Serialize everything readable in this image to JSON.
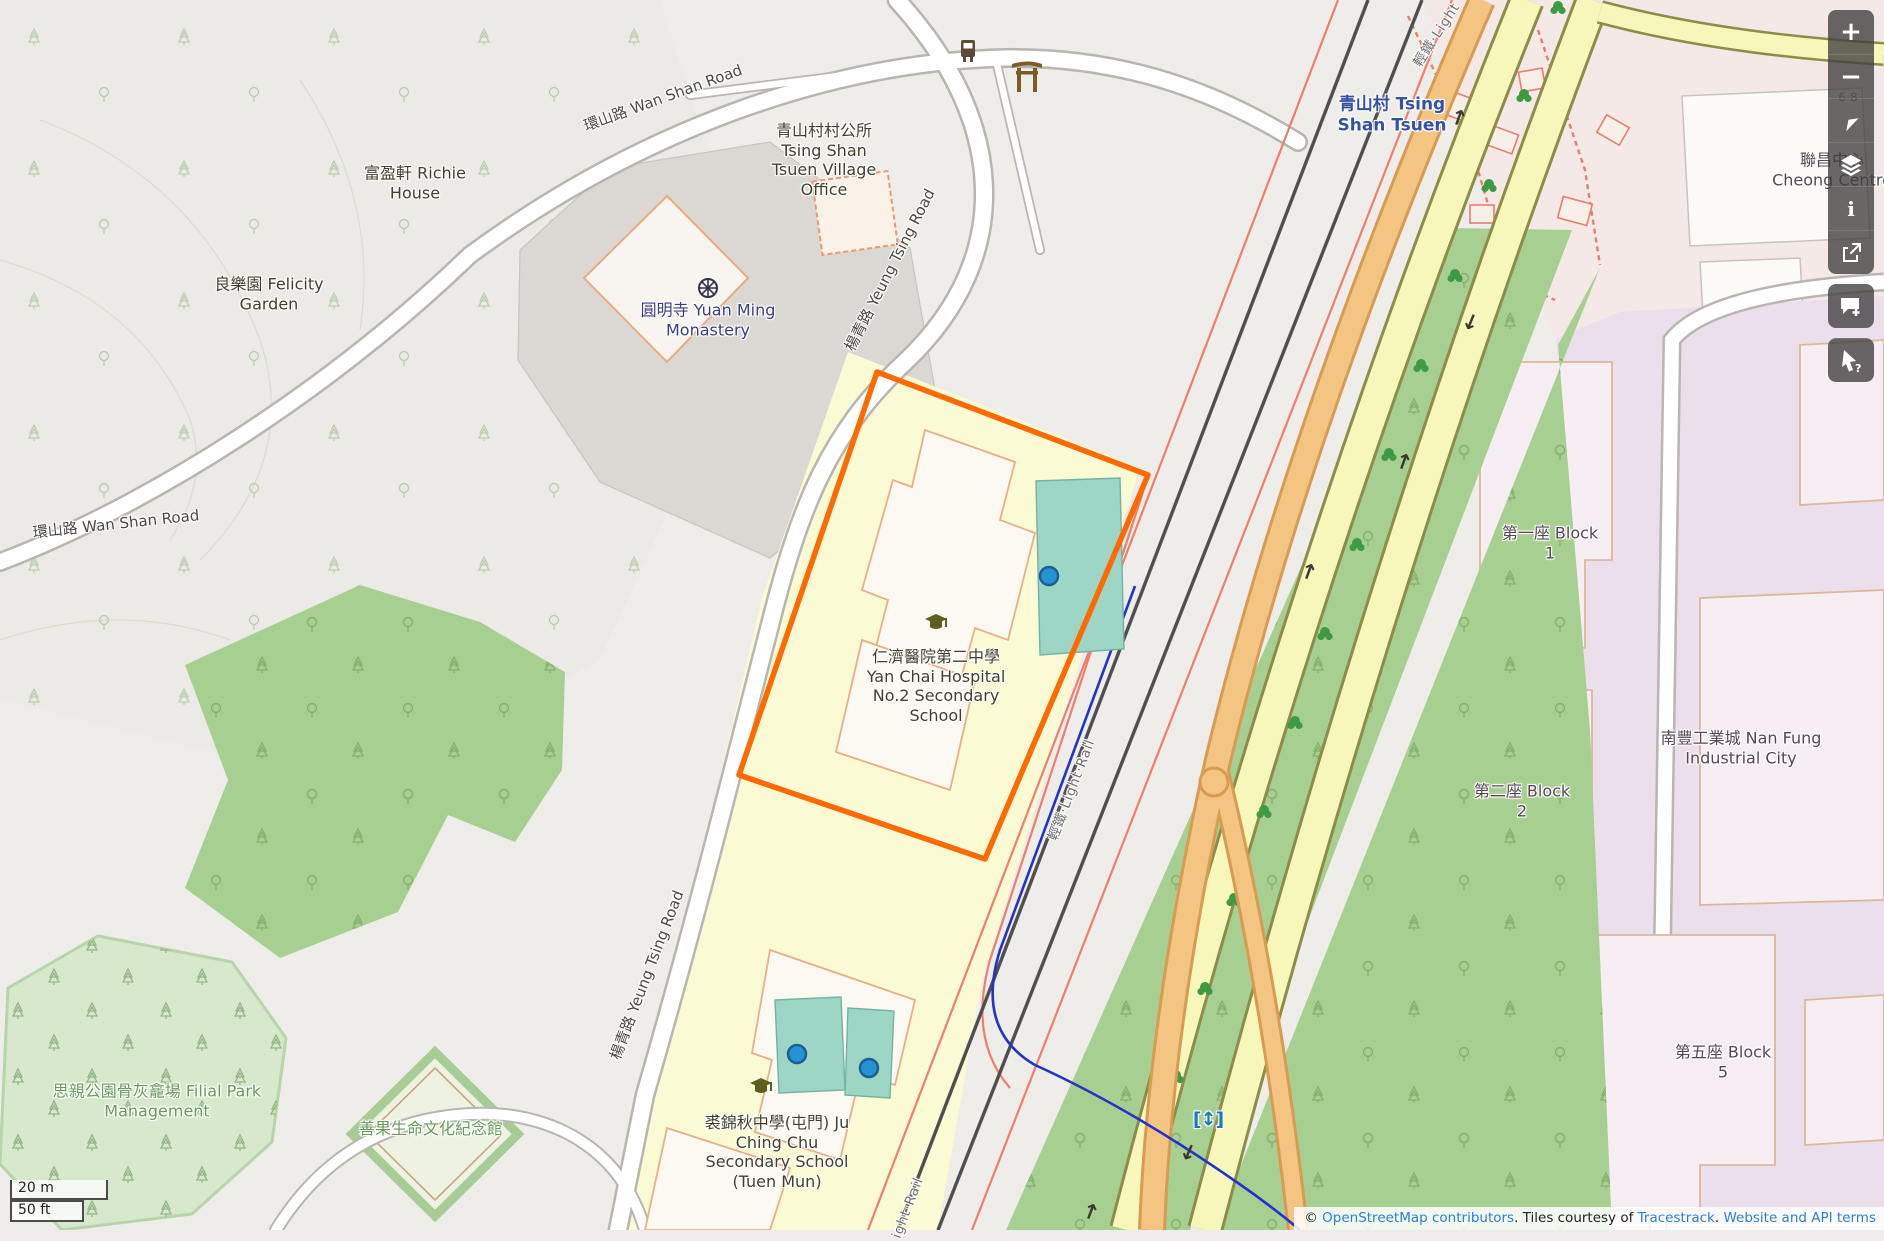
{
  "app": {
    "name": "OpenStreetMap map view"
  },
  "labels": [
    {
      "id": "wan-shan-road-top",
      "text": "環山路 Wan Shan Road"
    },
    {
      "id": "wan-shan-road-left",
      "text": "環山路 Wan Shan Road"
    },
    {
      "id": "yeung-tsing-upper",
      "text": "楊青路 Yeung Tsing Road"
    },
    {
      "id": "yeung-tsing-lower",
      "text": "楊青路 Yeung Tsing Road"
    },
    {
      "id": "village-office",
      "text": "青山村村公所 Tsing Shan Tsuen Village Office"
    },
    {
      "id": "monastery",
      "text": "圓明寺 Yuan Ming Monastery"
    },
    {
      "id": "richie-house",
      "text": "富盈軒 Richie House"
    },
    {
      "id": "felicity-garden",
      "text": "良樂園 Felicity Garden"
    },
    {
      "id": "tsing-shan-tsuen",
      "text": "青山村 Tsing Shan Tsuen"
    },
    {
      "id": "cheong-centre",
      "text": "聯昌中心 Cheong Centre"
    },
    {
      "id": "housenumber",
      "text": "6-8"
    },
    {
      "id": "yan-chai-school",
      "text": "仁濟醫院第二中學 Yan Chai Hospital No.2 Secondary School"
    },
    {
      "id": "ju-ching-chu-school",
      "text": "裘錦秋中學(屯門) Ju Ching Chu Secondary School (Tuen Mun)"
    },
    {
      "id": "filial-park",
      "text": "思親公園骨灰龕場 Filial Park Management"
    },
    {
      "id": "memorial-hall",
      "text": "善果生命文化紀念館"
    },
    {
      "id": "block-1",
      "text": "第一座 Block 1"
    },
    {
      "id": "block-2",
      "text": "第二座 Block 2"
    },
    {
      "id": "block-5",
      "text": "第五座 Block 5"
    },
    {
      "id": "nan-fung",
      "text": "南豐工業城 Nan Fung Industrial City"
    },
    {
      "id": "light-rail-top",
      "text": "輕鐵·Light"
    },
    {
      "id": "light-rail-mid",
      "text": "輕鐵·Light·Rail"
    },
    {
      "id": "light-rail-bottom",
      "text": "ight·Rail"
    },
    {
      "id": "station-entrance",
      "text": "[↕]"
    }
  ],
  "controls": {
    "glyphs": {
      "zoom_in": "+",
      "zoom_out": "−",
      "about": "i",
      "query": "?"
    },
    "items": [
      "zoom-in",
      "zoom-out",
      "show-my-location",
      "layers",
      "about",
      "share",
      "add-note",
      "query-features"
    ]
  },
  "scale": {
    "metric": "20 m",
    "imperial": "50 ft"
  },
  "attribution": {
    "prefix": "© ",
    "link_osm": "OpenStreetMap contributors",
    "middle": ". Tiles courtesy of ",
    "link_tiles": "Tracestrack",
    "separator": ". ",
    "link_terms": "Website and API terms"
  },
  "colors": {
    "highlight_orange": "#ff6a00",
    "school_area": "#fafad4",
    "pitch_teal": "#9ed6c6",
    "marker_blue": "#2593d2",
    "industrial_lavender": "#ecdfec",
    "park_green": "#a8cf92",
    "road_yellow": "#f7f7bb",
    "road_orange": "#f4c483",
    "railway_gray": "#4f4f4f",
    "link_blue": "#2a7fd4"
  }
}
